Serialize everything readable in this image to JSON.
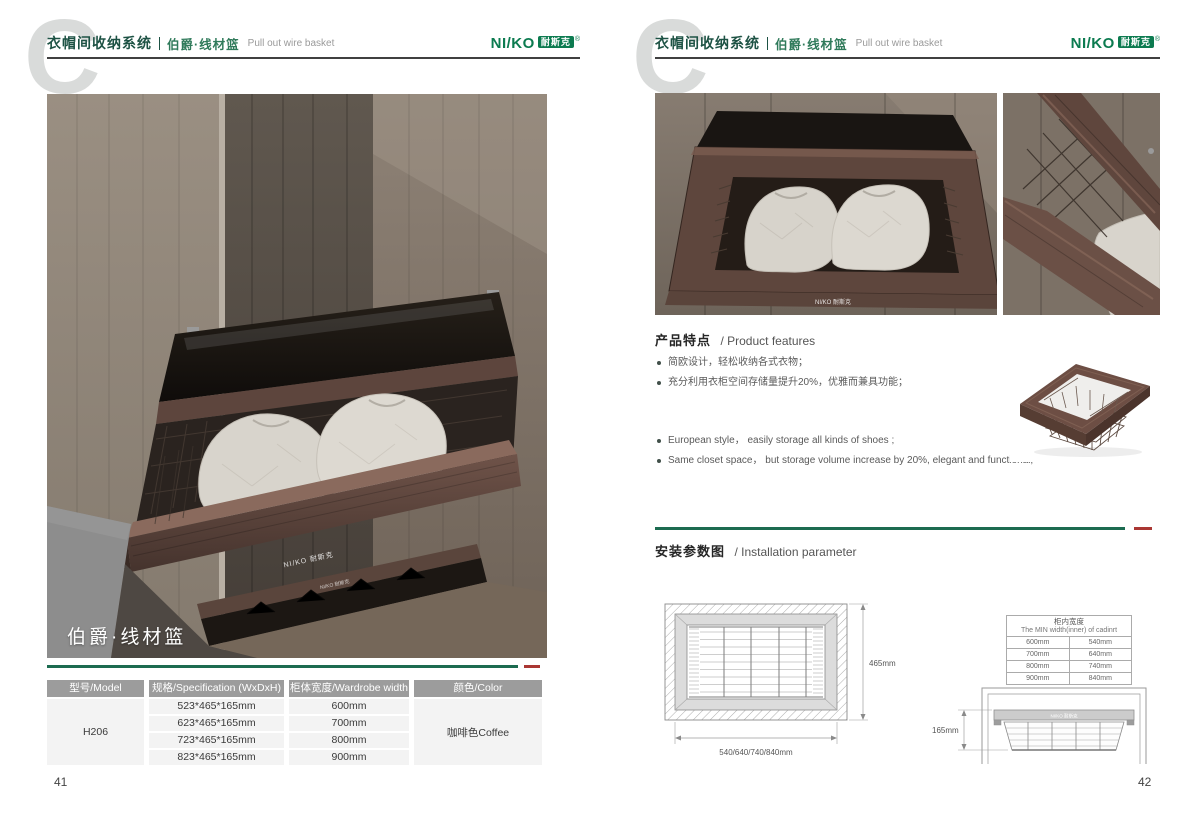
{
  "header": {
    "watermark": "C",
    "system_zh": "衣帽间收纳系统",
    "product_zh": "伯爵·线材篮",
    "product_en": "Pull out wire basket",
    "logo_text": "NI/KO",
    "logo_box": "耐斯克",
    "logo_reg": "®"
  },
  "colors": {
    "brand_green": "#0c7b50",
    "divider_green": "#1c6b50",
    "divider_red": "#aa3733",
    "table_header_gray": "#9c9c9c",
    "frame_coffee": "#5e463d"
  },
  "left_page": {
    "page_number": "41",
    "photo_caption": "伯爵·线材篮",
    "rail_text": "NI/KO 耐斯克",
    "spec_table": {
      "headers": [
        "型号/Model",
        "规格/Specification (WxDxH)",
        "柜体宽度/Wardrobe width",
        "颜色/Color"
      ],
      "model": "H206",
      "rows": [
        {
          "spec": "523*465*165mm",
          "width": "600mm"
        },
        {
          "spec": "623*465*165mm",
          "width": "700mm"
        },
        {
          "spec": "723*465*165mm",
          "width": "800mm"
        },
        {
          "spec": "823*465*165mm",
          "width": "900mm"
        }
      ],
      "color": "咖啡色Coffee"
    }
  },
  "right_page": {
    "page_number": "42",
    "features": {
      "title_zh": "产品特点",
      "title_en": "/ Product features",
      "bullets_zh": [
        "简欧设计，轻松收纳各式衣物；",
        "充分利用衣柜空间存储量提升20%，优雅而兼具功能；"
      ],
      "bullets_en": [
        "European style， easily storage all kinds of shoes ;",
        "Same closet space， but storage volume increase by 20%, elegant and functional;"
      ]
    },
    "installation": {
      "title_zh": "安装参数图",
      "title_en": "/ Installation parameter",
      "top_view": {
        "depth_label": "465mm",
        "width_label": "540/640/740/840mm"
      },
      "min_width_table": {
        "title_zh": "柜内宽度",
        "title_en": "The MIN width(inner) of cadinrt",
        "rows": [
          {
            "cabinet": "600mm",
            "min": "540mm"
          },
          {
            "cabinet": "700mm",
            "min": "640mm"
          },
          {
            "cabinet": "800mm",
            "min": "740mm"
          },
          {
            "cabinet": "900mm",
            "min": "840mm"
          }
        ]
      },
      "front_view": {
        "height_label": "165mm"
      }
    }
  }
}
